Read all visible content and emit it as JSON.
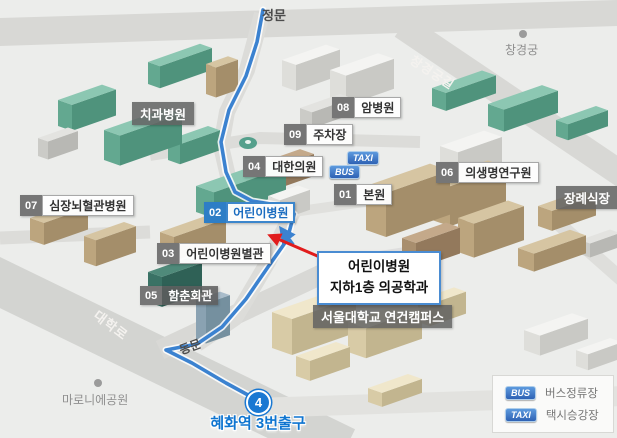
{
  "map": {
    "gates": {
      "main": "정문",
      "east": "동문"
    },
    "roads": [
      {
        "name": "창경궁길"
      },
      {
        "name": "대학로"
      }
    ],
    "places": [
      {
        "label": "창경궁"
      },
      {
        "label": "마로니에공원"
      }
    ],
    "unnumbered": [
      {
        "label": "치과병원"
      },
      {
        "label": "장례식장"
      },
      {
        "label": "서울대학교 연건캠퍼스"
      }
    ],
    "pois": [
      {
        "num": "01",
        "label": "본원"
      },
      {
        "num": "02",
        "label": "어린이병원",
        "highlight": true
      },
      {
        "num": "03",
        "label": "어린이병원별관"
      },
      {
        "num": "04",
        "label": "대한의원"
      },
      {
        "num": "05",
        "label": "함춘회관"
      },
      {
        "num": "06",
        "label": "의생명연구원"
      },
      {
        "num": "07",
        "label": "심장뇌혈관병원"
      },
      {
        "num": "08",
        "label": "암병원"
      },
      {
        "num": "09",
        "label": "주차장"
      }
    ],
    "stops": {
      "taxi": "TAXI",
      "bus": "BUS"
    },
    "callout": {
      "line1": "어린이병원",
      "line2": "지하1층 의공학과"
    },
    "subway": {
      "line_number": "4",
      "exit_label": "혜화역 3번출구"
    }
  },
  "legend": {
    "items": [
      {
        "badge": "BUS",
        "label": "버스정류장"
      },
      {
        "badge": "TAXI",
        "label": "택시승강장"
      }
    ]
  },
  "colors": {
    "route_blue": "#3b82d0",
    "highlight_blue": "#2e7ec6",
    "arrow_red": "#e11c1c",
    "subway_line4": "#1a78d2",
    "road_gray": "#d8d8d5",
    "background": "#ecedeb"
  }
}
